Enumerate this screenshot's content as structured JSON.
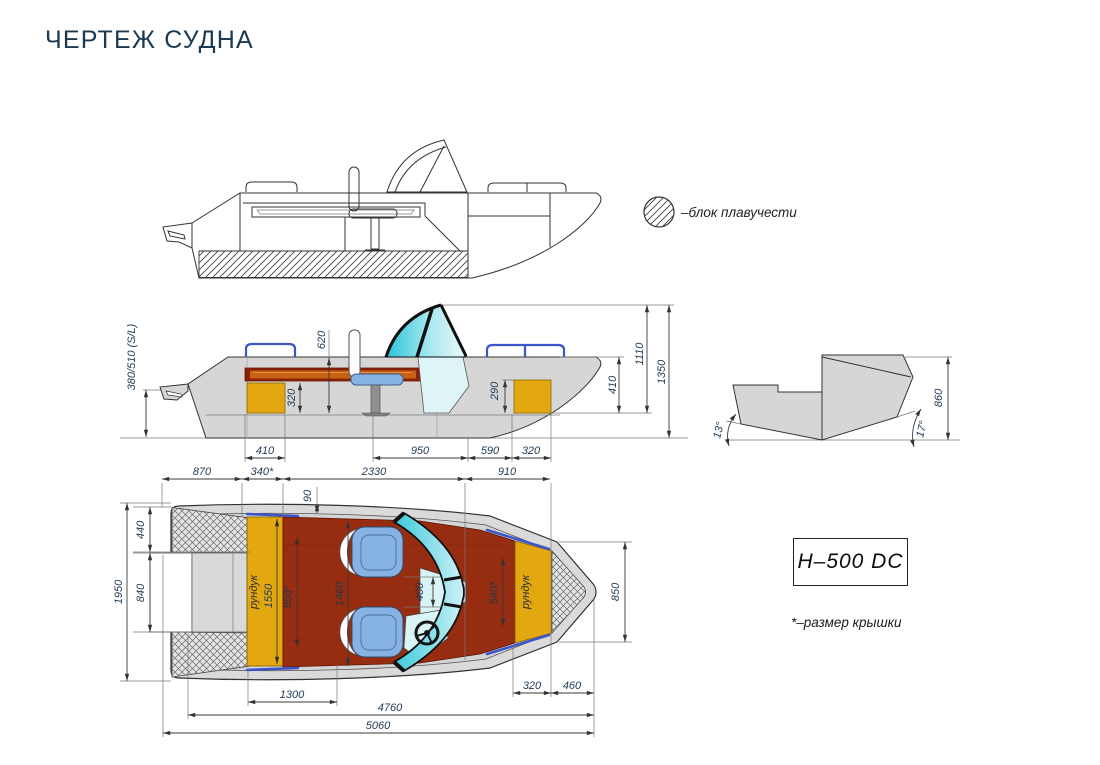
{
  "page": {
    "title": "ЧЕРТЕЖ СУДНА"
  },
  "legend": {
    "label": "–блок плавучести"
  },
  "model_badge": {
    "label": "H–500 DC"
  },
  "footnote": {
    "label": "*–размер крышки"
  },
  "colors": {
    "title": "#1b3a52",
    "hull_gray": "#d6d6d6",
    "cockpit_floor": "#962c10",
    "locker_yellow": "#e3a70f",
    "seat_blue": "#86b3e3",
    "rail_blue": "#3c55c8",
    "glass_cyan": "#2ec5da",
    "dim_text": "#1f3a55"
  },
  "side_view": {
    "dims": {
      "height_transom": "380/510 (S/L)",
      "cockpit_depth": "620",
      "stern_locker_height": "320",
      "bow_locker_height": "290",
      "bow_depth": "410",
      "height_inner": "1110",
      "height_overall": "1350",
      "stern_locker_width": "410",
      "console_span": "950",
      "bow_span": "590",
      "bow_locker_width": "320"
    }
  },
  "transom_view": {
    "dims": {
      "height": "860",
      "deadrise_left": "13°",
      "deadrise_right": "17°"
    }
  },
  "plan_view": {
    "labels": {
      "stern_locker": "рундук",
      "bow_locker": "рундук"
    },
    "dims_top": {
      "stern_overhang": "870",
      "stern_hatch": "340*",
      "cockpit_length": "2330",
      "bow_deck": "910",
      "gunwale": "90"
    },
    "dims_left": {
      "hatch_width": "440",
      "motor_well": "840",
      "beam": "1950"
    },
    "dims_right": {
      "bow_width": "850"
    },
    "dims_inner": {
      "stern_locker_len": "1550",
      "floor_hatch": "950*",
      "cockpit_width": "1460",
      "seat_gap": "400",
      "bow_hatch": "540*"
    },
    "dims_bottom": {
      "cockpit_floor": "1300",
      "bow_locker_len": "320",
      "bow_tip": "460",
      "hull_length": "4760",
      "overall_length": "5060"
    }
  }
}
